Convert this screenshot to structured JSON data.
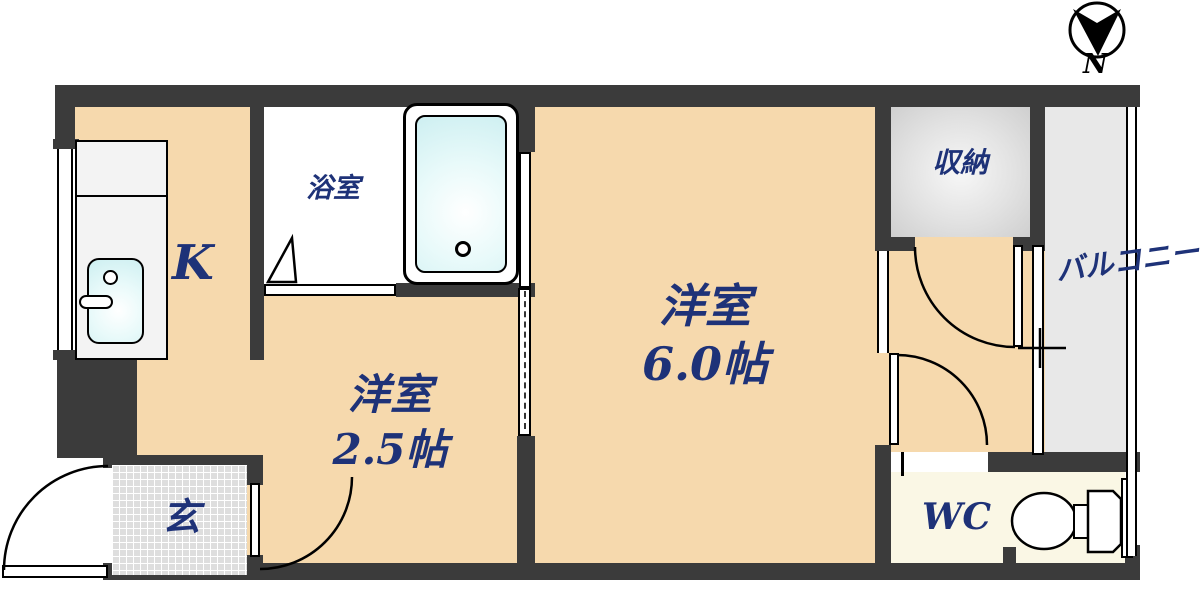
{
  "compass": {
    "label": "N"
  },
  "rooms": {
    "kitchen": {
      "label": "K"
    },
    "bathroom": {
      "label": "浴室"
    },
    "western_room_small": {
      "name": "洋室",
      "size": "2.5帖"
    },
    "western_room_large": {
      "name": "洋室",
      "size": "6.0帖"
    },
    "closet": {
      "label": "収納"
    },
    "balcony": {
      "label": "バルコニー"
    },
    "wc": {
      "label": "WC"
    },
    "entrance": {
      "label": "玄"
    }
  },
  "colors": {
    "wall": "#3b3b3b",
    "room_floor": "#f6d9ad",
    "label_navy": "#1e3278",
    "bathroom_floor": "#ffffff",
    "wc_floor": "#faf7e5",
    "closet_floor": "#e2e2e2",
    "balcony_floor": "#e8e8e8",
    "entrance_floor": "#dedede",
    "fixture_cyan": "#cdeff1"
  }
}
